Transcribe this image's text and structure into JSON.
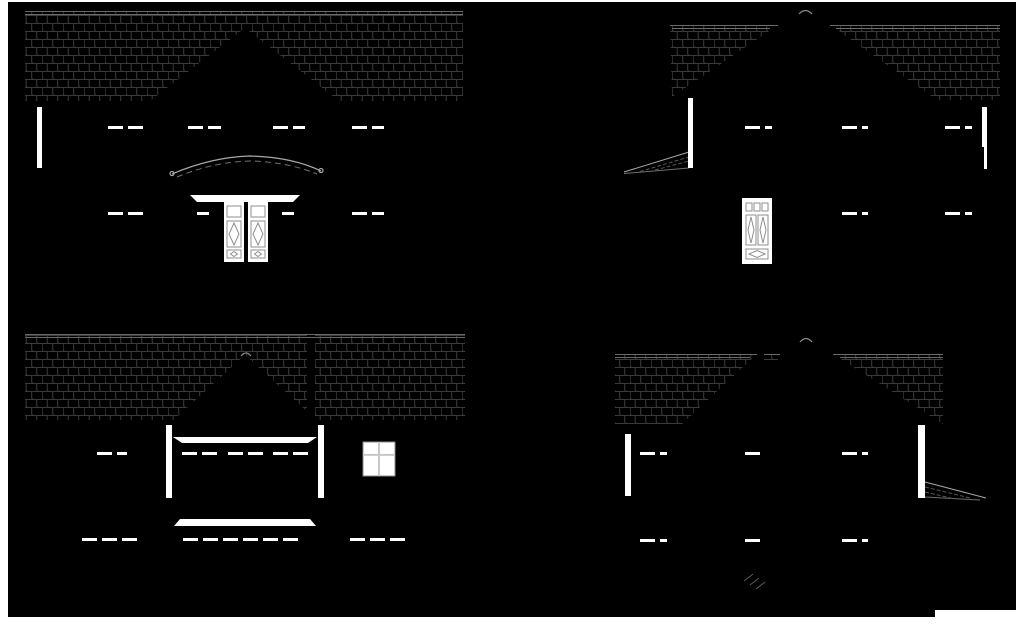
{
  "page": {
    "background": "#ffffff",
    "canvas": {
      "x": 8,
      "y": 2,
      "width": 1008,
      "height": 615,
      "color": "#000000"
    },
    "corner_notch": {
      "x": 935,
      "y": 610,
      "width": 89,
      "height": 22
    }
  },
  "colors": {
    "shingle_line": "#3b3b3b",
    "roof_edge": "#6a6a6a",
    "porch_arc": "#a8a8a8",
    "porch_arc_dim": "#6f6f6f",
    "white": "#ffffff",
    "door_line": "#8f8f8f",
    "window_border": "#8a8a8a",
    "window_divider": "#c8c8c8",
    "break_mark": "#5a5a5a",
    "caret": "#888888"
  },
  "dash_style": {
    "length": 15,
    "gap": 5,
    "height": 3
  },
  "elevations": [
    {
      "id": "front-elevation",
      "dash_rows": [
        {
          "y": 126,
          "spans": [
            [
              108,
              143
            ],
            [
              188,
              221
            ],
            [
              273,
              305
            ],
            [
              352,
              384
            ]
          ]
        },
        {
          "y": 212,
          "spans": [
            [
              108,
              143
            ],
            [
              197,
              209
            ],
            [
              282,
              294
            ],
            [
              352,
              384
            ]
          ]
        }
      ],
      "trim_bars": [
        [
          37,
          107,
          5,
          61
        ]
      ],
      "windows": []
    },
    {
      "id": "right-side-elevation",
      "dash_rows": [
        {
          "y": 126,
          "spans": [
            [
              745,
              772
            ],
            [
              842,
              868
            ],
            [
              945,
              972
            ]
          ]
        },
        {
          "y": 212,
          "spans": [
            [
              842,
              868
            ],
            [
              945,
              972
            ]
          ]
        }
      ],
      "trim_bars": [
        [
          688,
          98,
          5,
          70
        ],
        [
          982,
          107,
          5,
          40
        ],
        [
          984,
          147,
          3,
          22
        ]
      ],
      "windows": []
    },
    {
      "id": "rear-elevation",
      "dash_rows": [
        {
          "y": 452,
          "spans": [
            [
              97,
              127
            ],
            [
              182,
              217
            ],
            [
              228,
              263
            ],
            [
              273,
              308
            ]
          ]
        },
        {
          "y": 538,
          "spans": [
            [
              82,
              143
            ],
            [
              183,
              307
            ],
            [
              350,
              407
            ]
          ]
        }
      ],
      "trim_bars": [
        [
          166,
          425,
          6,
          73
        ],
        [
          318,
          425,
          6,
          73
        ]
      ],
      "windows": [
        {
          "x": 363,
          "y": 442,
          "w": 32,
          "h": 34,
          "hdiv": 0.38,
          "vdiv": 0.5
        }
      ]
    },
    {
      "id": "left-side-elevation",
      "dash_rows": [
        {
          "y": 452,
          "spans": [
            [
              640,
              667
            ],
            [
              745,
              770
            ],
            [
              842,
              868
            ]
          ]
        },
        {
          "y": 539,
          "spans": [
            [
              640,
              667
            ],
            [
              745,
              770
            ],
            [
              842,
              868
            ]
          ]
        }
      ],
      "trim_bars": [
        [
          625,
          434,
          6,
          62
        ],
        [
          918,
          425,
          7,
          73
        ]
      ],
      "windows": []
    }
  ]
}
